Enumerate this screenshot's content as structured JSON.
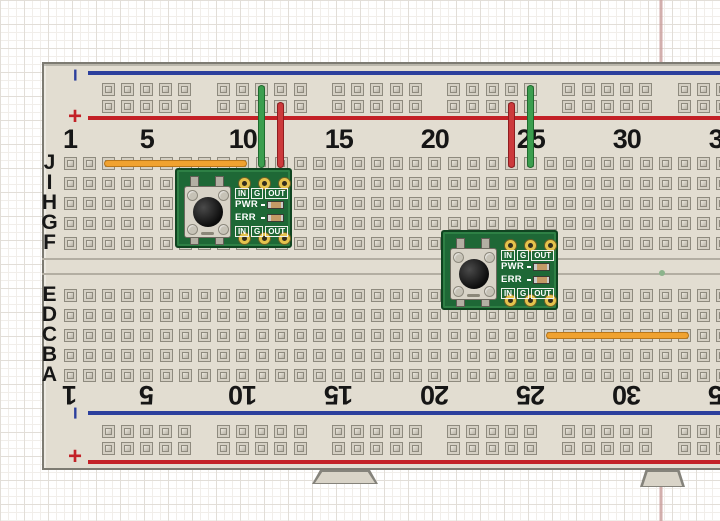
{
  "paper": {
    "margin_line_color": "#c89c9a",
    "margin_line_x": 659
  },
  "board": {
    "column_numbers": [
      "1",
      "5",
      "10",
      "15",
      "20",
      "25",
      "30",
      "35"
    ],
    "column_number_positions": [
      1,
      5,
      10,
      15,
      20,
      25,
      30,
      35
    ],
    "row_labels_top": [
      "J",
      "I",
      "H",
      "G",
      "F"
    ],
    "row_labels_bottom": [
      "E",
      "D",
      "C",
      "B",
      "A"
    ],
    "rail_labels": {
      "minus": "−",
      "plus": "+"
    },
    "colors": {
      "body": "#e2ddd1",
      "blue_rail": "#2c3f9d",
      "red_rail": "#c32127",
      "label": "#161616"
    }
  },
  "module_labels": {
    "io": [
      "IN",
      "G",
      "OUT"
    ],
    "pwr": "PWR",
    "err": "ERR"
  },
  "modules": [
    {
      "name": "button-breakout-1",
      "x": 175,
      "y": 168,
      "grid_ref": "cols 10-12, rows I-F"
    },
    {
      "name": "button-breakout-2",
      "x": 441,
      "y": 230,
      "grid_ref": "cols 24-26, rows F-E"
    }
  ],
  "wires": [
    {
      "name": "orange-jumper-top",
      "hex": "#f0a230",
      "border": "#b9771a",
      "from": "J3",
      "to": "J10",
      "x": 104,
      "y": 160,
      "w": 143,
      "h": 7
    },
    {
      "name": "green-wire-left",
      "hex": "#3c9e4f",
      "border": "#1f6b2e",
      "from": "top-rail-row-1",
      "to": "J11",
      "x": 258,
      "y": 85,
      "w": 7,
      "h": 83
    },
    {
      "name": "red-wire-left",
      "hex": "#cc3a3c",
      "border": "#8f1d20",
      "from": "top-rail-row-2",
      "to": "J12",
      "x": 277,
      "y": 102,
      "w": 7,
      "h": 66
    },
    {
      "name": "red-wire-right",
      "hex": "#cc3a3c",
      "border": "#8f1d20",
      "from": "top-rail-row-2",
      "to": "J24",
      "x": 508,
      "y": 102,
      "w": 7,
      "h": 66
    },
    {
      "name": "green-wire-right",
      "hex": "#3c9e4f",
      "border": "#1f6b2e",
      "from": "top-rail-row-1",
      "to": "J25",
      "x": 527,
      "y": 85,
      "w": 7,
      "h": 83
    },
    {
      "name": "orange-jumper-bottom",
      "hex": "#f0a230",
      "border": "#b9771a",
      "from": "C26",
      "to": "C33",
      "x": 546,
      "y": 332,
      "w": 143,
      "h": 7
    }
  ]
}
